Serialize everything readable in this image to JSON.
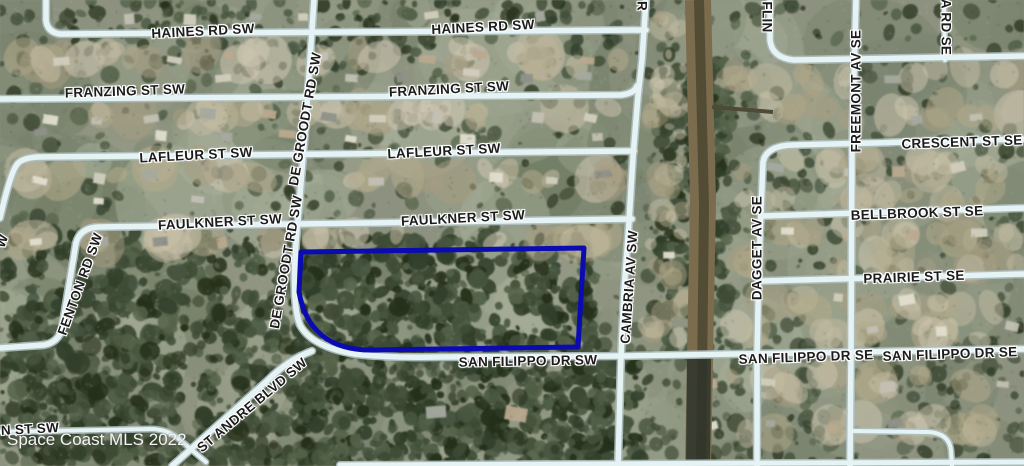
{
  "map": {
    "type": "aerial-parcel-map",
    "watermark": "Space Coast MLS 2022",
    "parcel_color": "#0b0bb2",
    "road_color": "#e6f3f4",
    "road_casing_color": "#aebfc0",
    "canal_color": "#7b6c4e",
    "labels": [
      {
        "text": "HAINES RD SW",
        "x": 203,
        "y": 31,
        "rot": -3
      },
      {
        "text": "HAINES RD SW",
        "x": 483,
        "y": 27,
        "rot": -3
      },
      {
        "text": "FRANZING ST SW",
        "x": 125,
        "y": 91,
        "rot": -2
      },
      {
        "text": "FRANZING ST SW",
        "x": 449,
        "y": 89,
        "rot": -3
      },
      {
        "text": "LAFLEUR ST SW",
        "x": 196,
        "y": 155,
        "rot": -3
      },
      {
        "text": "LAFLEUR ST SW",
        "x": 444,
        "y": 151,
        "rot": -3
      },
      {
        "text": "FAULKNER ST SW",
        "x": 220,
        "y": 222,
        "rot": -3
      },
      {
        "text": "FAULKNER ST SW",
        "x": 463,
        "y": 218,
        "rot": -3
      },
      {
        "text": "DE GROODT RD SW",
        "x": 286,
        "y": 262,
        "rot": -80
      },
      {
        "text": "DE GROODT RD SW",
        "x": 305,
        "y": 119,
        "rot": -80
      },
      {
        "text": "FENTON RD SW",
        "x": 80,
        "y": 284,
        "rot": -70
      },
      {
        "text": "CAMBRIA AV SW",
        "x": 629,
        "y": 287,
        "rot": -86
      },
      {
        "text": "ST ANDRE BLVD SW",
        "x": 252,
        "y": 405,
        "rot": -40
      },
      {
        "text": "SAN FILIPPO DR SW",
        "x": 528,
        "y": 361,
        "rot": -1
      },
      {
        "text": "SAN FILIPPO DR SE",
        "x": 806,
        "y": 357,
        "rot": -2
      },
      {
        "text": "SAN FILIPPO DR SE",
        "x": 950,
        "y": 354,
        "rot": -2
      },
      {
        "text": "N ST SW",
        "x": 30,
        "y": 429,
        "rot": -3
      },
      {
        "text": "CRESCENT ST SE",
        "x": 962,
        "y": 142,
        "rot": -2
      },
      {
        "text": "BELLBROOK ST SE",
        "x": 917,
        "y": 213,
        "rot": -2
      },
      {
        "text": "PRAIRIE ST SE",
        "x": 914,
        "y": 277,
        "rot": -2
      },
      {
        "text": "FREEMONT AV SE",
        "x": 856,
        "y": 91,
        "rot": -90
      },
      {
        "text": "DAGGET AV SE",
        "x": 757,
        "y": 248,
        "rot": -90
      },
      {
        "text": "FLIN",
        "x": 767,
        "y": 17,
        "rot": 90
      },
      {
        "text": "A RD SE",
        "x": 946,
        "y": 27,
        "rot": 90
      },
      {
        "text": "W",
        "x": 2,
        "y": 241,
        "rot": -70
      },
      {
        "text": "R",
        "x": 642,
        "y": 6,
        "rot": 90
      }
    ]
  }
}
